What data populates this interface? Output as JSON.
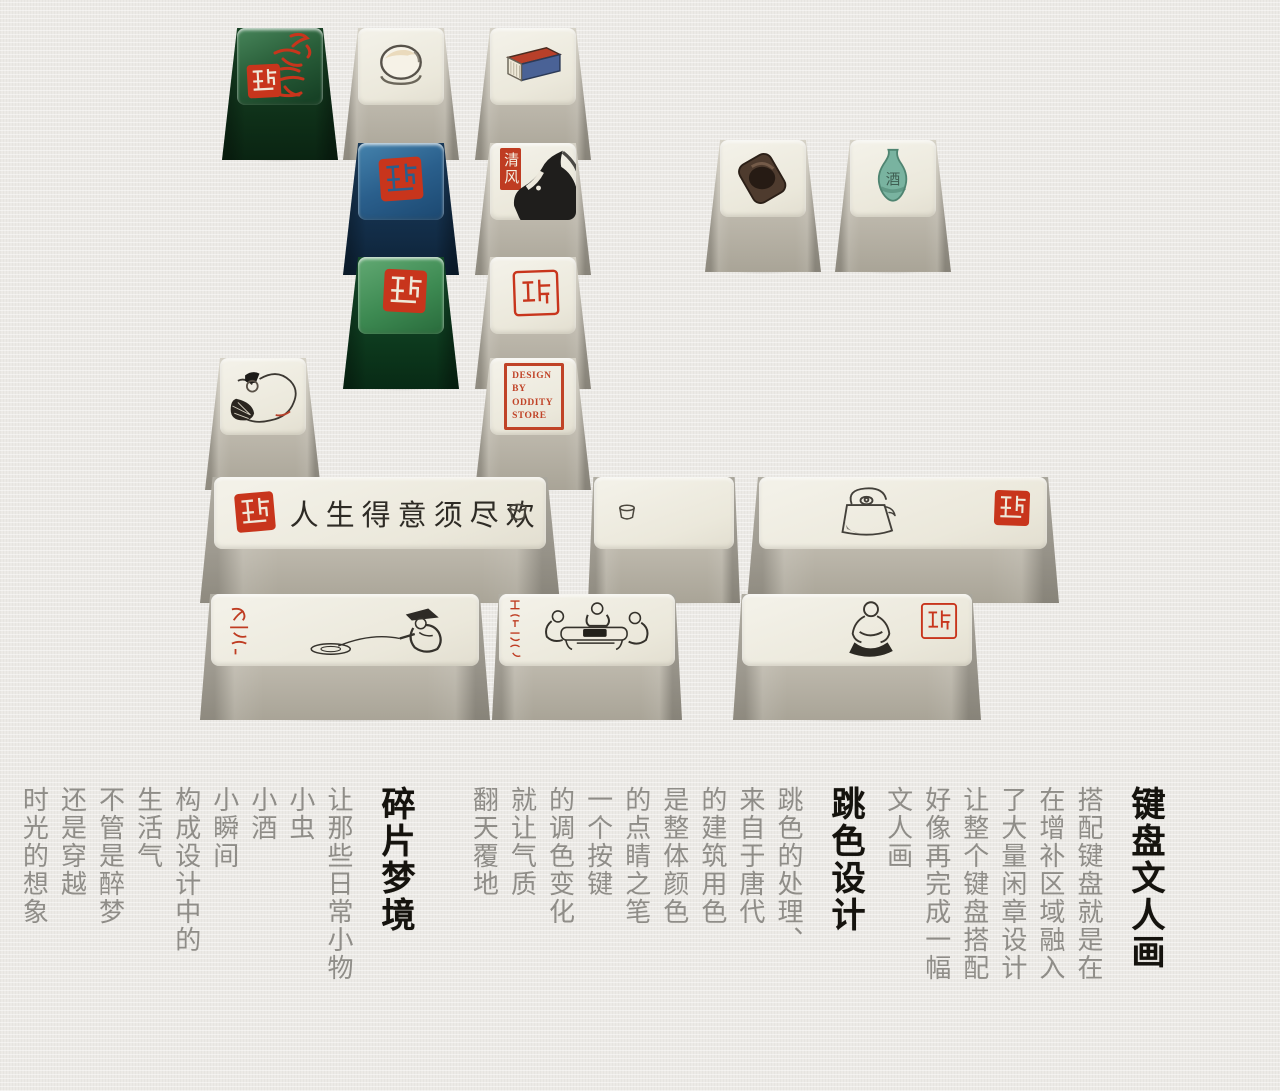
{
  "poster": {
    "background": "#eceae6",
    "seal_red": "#bf3c22",
    "ink_black": "#2f2c26",
    "keycap_cream": "#efece1"
  },
  "sections": [
    {
      "heading": "碎片梦境",
      "columns": [
        "让那些日常小物",
        "小虫",
        "小酒",
        "小瞬间",
        "构成设计中的",
        "生活气",
        "不管是醉梦",
        "还是穿越",
        "时光的想象"
      ]
    },
    {
      "heading": "跳色设计",
      "columns": [
        "跳色的处理、",
        "来自于唐代",
        "的建筑用色",
        "是整体颜色",
        "的点睛之笔",
        "一个按键",
        "的调色变化",
        "就让气质",
        "翻天覆地"
      ]
    },
    {
      "heading": "键盘文人画",
      "columns": [
        "搭配键盘就是在",
        "在增补区域融入",
        "了大量闲章设计",
        "让整个键盘搭配",
        "好像再完成一幅",
        "文人画"
      ]
    }
  ],
  "keycaps": {
    "green_calligraphy": {
      "art": "red-brush-calligraphy-and-seal",
      "top_color": "#2a5f3a"
    },
    "bowl": {
      "art": "ink-wash-bowl"
    },
    "book": {
      "art": "blue-stitched-book"
    },
    "blue_seal": {
      "art": "red-seal-stamp",
      "top_color": "#2a5f8c"
    },
    "horse": {
      "art": "ink-horse-head",
      "seal_text": "清风"
    },
    "green_seal": {
      "art": "red-seal-stamp",
      "top_color": "#3d8a52"
    },
    "white_seal": {
      "art": "red-seal-script-stamp"
    },
    "inkstone": {
      "art": "ink-stone"
    },
    "flask": {
      "art": "celadon-wine-flask",
      "glyph": "酒"
    },
    "dozing_figure": {
      "art": "figure-dozing-on-basket"
    },
    "oddity": {
      "lines": [
        "DESIGN",
        "BY",
        "ODDITY",
        "STORE"
      ]
    },
    "calligraphy_bar": {
      "text": "人生得意须尽欢",
      "art": "seal-calligraphy-teacup"
    },
    "cup_bar": {
      "art": "ink-teacup"
    },
    "teapot_bar": {
      "art": "ink-teapot-and-seal"
    },
    "fisherman_bar": {
      "art": "fisherman-with-red-inscription"
    },
    "gathering_bar": {
      "art": "figures-around-game-table-with-red-inscription"
    },
    "sitting_bar": {
      "art": "seated-elder-with-seal"
    }
  }
}
